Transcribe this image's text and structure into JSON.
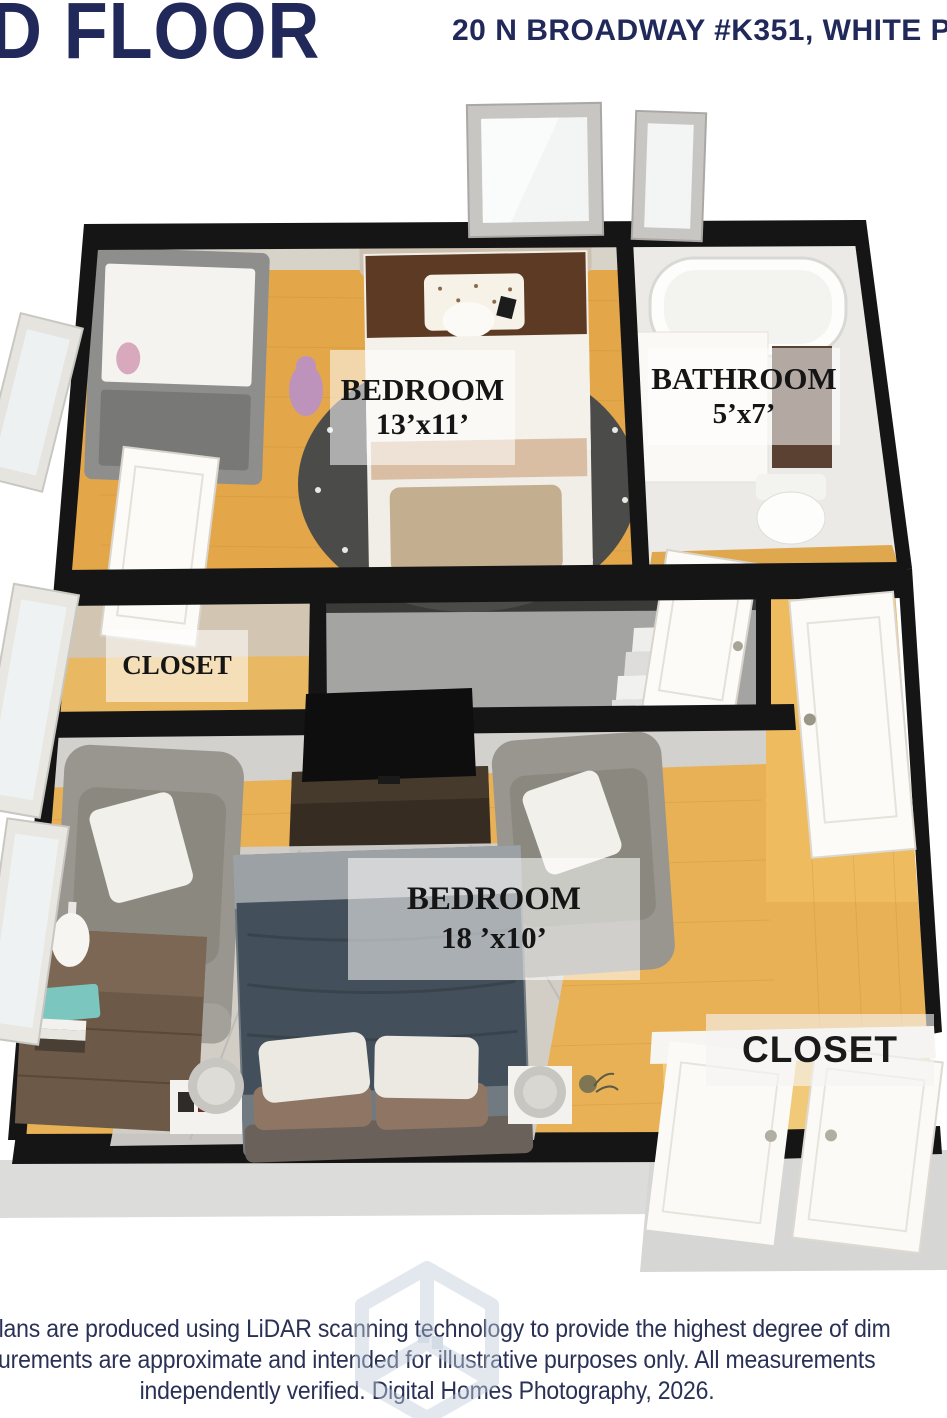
{
  "header": {
    "floor_label": "D FLOOR",
    "address": "20 N BROADWAY #K351, WHITE PL"
  },
  "floor_plan": {
    "rooms": [
      {
        "name": "BEDROOM",
        "dimensions": "13’x11’"
      },
      {
        "name": "BATHROOM",
        "dimensions": "5’x7’"
      },
      {
        "name": "CLOSET",
        "dimensions": ""
      },
      {
        "name": "BEDROOM",
        "dimensions": "18 ’x10’"
      },
      {
        "name": "CLOSET",
        "dimensions": ""
      }
    ]
  },
  "footer": {
    "line1": "plans are produced using LiDAR scanning technology to provide the highest degree of dim",
    "line2": "urements are approximate and intended for illustrative purposes only. All measurements",
    "line3": "independently verified. Digital Homes Photography, 2026."
  },
  "icons": {
    "watermark": "cube-logo-icon"
  },
  "colors": {
    "accent_navy": "#20295a",
    "wood_floor": "#e3a74a",
    "wall_black": "#151515",
    "stairwell_gray": "#a4a4a2",
    "label_text": "#151515",
    "watermark_blue": "#c3cedd"
  }
}
